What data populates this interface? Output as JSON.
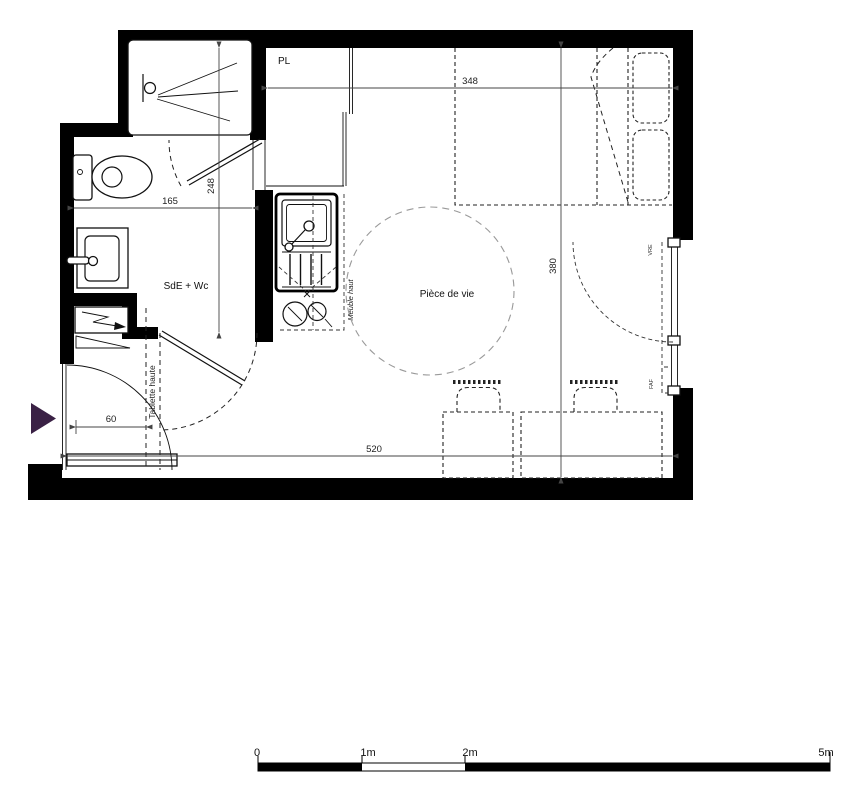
{
  "plan": {
    "rooms": {
      "bathroom": "SdE + Wc",
      "living_room": "Pièce de vie",
      "closet": "PL"
    },
    "labels": {
      "high_shelf": "Tablette haute",
      "upper_cabinet": "Meuble haut",
      "window_shutter": "VRE",
      "window_type": "FAF"
    },
    "dimensions": {
      "living_width": "348",
      "bathroom_depth": "248",
      "bathroom_width": "165",
      "living_depth": "380",
      "total_width": "520",
      "entry_clearance": "60"
    },
    "scale": {
      "ticks": [
        "0",
        "1m",
        "2m",
        "5m"
      ]
    },
    "colors": {
      "wall": "#000000",
      "entrance_arrow": "#3A2145"
    }
  }
}
